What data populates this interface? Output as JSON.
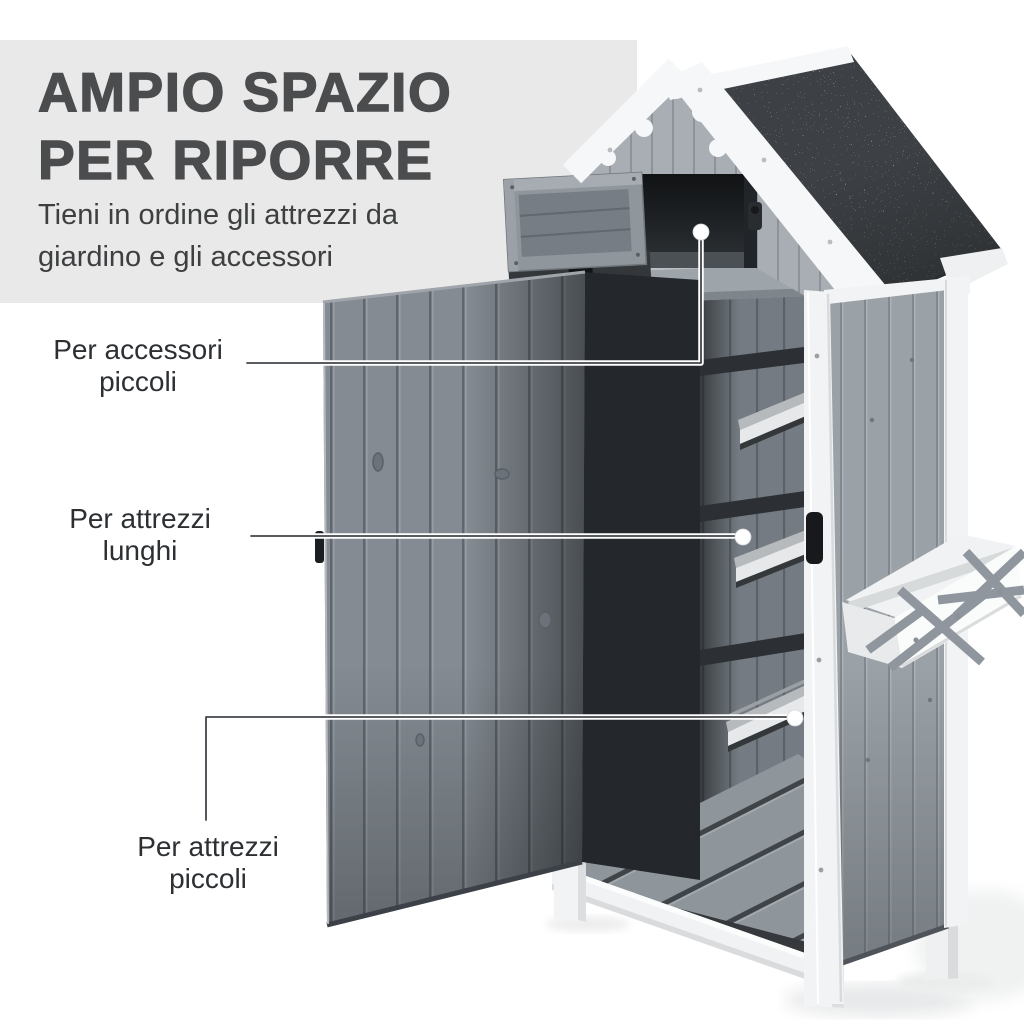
{
  "page": {
    "background_color": "#ffffff"
  },
  "title_panel": {
    "background_color": "#e9e9e9",
    "title_line1": "AMPIO SPAZIO",
    "title_line2": "PER RIPORRE",
    "title_color": "#4b4c4e",
    "subtitle_line1": "Tieni in ordine gli attrezzi da",
    "subtitle_line2": "giardino e gli accessori",
    "subtitle_color": "#3d3f41"
  },
  "callouts": [
    {
      "label_line1": "Per accessori",
      "label_line2": "piccoli",
      "points_to": "top-storage-compartment"
    },
    {
      "label_line1": "Per attrezzi",
      "label_line2": "lunghi",
      "points_to": "middle-shelf"
    },
    {
      "label_line1": "Per attrezzi",
      "label_line2": "piccoli",
      "points_to": "bottom-shelf"
    }
  ],
  "illustration": {
    "subject": "garden-tool-storage-cabinet",
    "colors": {
      "roof_asphalt": "#3d4145",
      "roof_speckle": "#cfd3d6",
      "trim_white": "#f2f3f4",
      "door_wood": "#848b92",
      "side_wood": "#9aa1a7",
      "back_wall_wood": "#747b82",
      "gable_wood": "#a8aeb3",
      "interior_dark": "#17191c",
      "shelf_top": "#b6babd",
      "floor_slat": "#8e959b",
      "handle_black": "#17191c",
      "label_text": "#2d3032",
      "leader_line_core": "#42464a",
      "leader_line_halo": "#ffffff"
    }
  }
}
